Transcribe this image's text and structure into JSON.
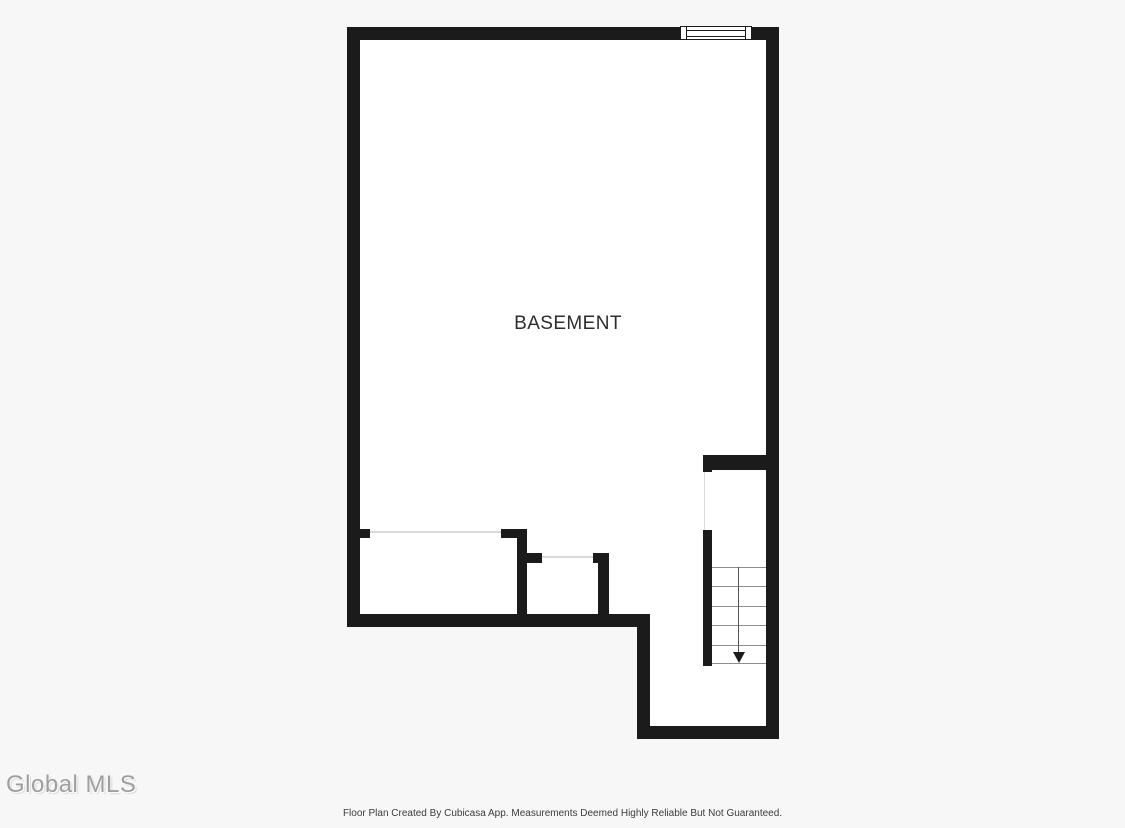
{
  "theme": {
    "page_bg": "#f7f7f7",
    "plan_bg": "#ffffff",
    "wall": "#1b1b1b",
    "opening_line": "#dadada",
    "tread_line": "#8e8e8e",
    "stair_line": "#555555",
    "label_color": "#2d2d2d",
    "watermark_color": "#9e9e9e",
    "footer_color": "#3c3c3c"
  },
  "floor_plan": {
    "room_label": "BASEMENT",
    "window_count": 1,
    "stairs": {
      "steps": 5,
      "direction": "down"
    }
  },
  "watermark": {
    "text": "Global MLS"
  },
  "footer": {
    "disclaimer": "Floor Plan Created By Cubicasa App. Measurements Deemed Highly Reliable But Not Guaranteed."
  }
}
